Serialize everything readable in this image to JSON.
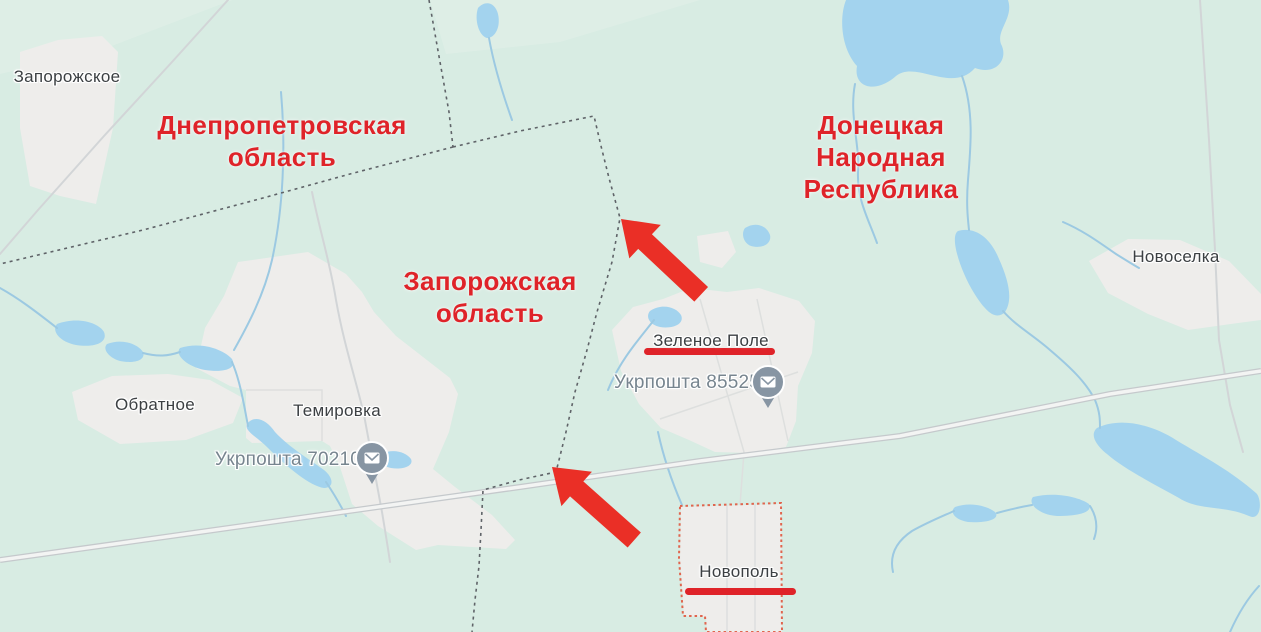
{
  "colors": {
    "land": "#d8ece3",
    "water": "#a3d3ee",
    "water_stroke": "#9cc9e2",
    "settlement": "#eeedeb",
    "road_casing": "#c5c9cc",
    "road_fill": "#f3f4f3",
    "thin_road": "#d2d5d7",
    "boundary": "#5f6368",
    "region_highlight": "#e0654e",
    "annotation_red": "#df2329",
    "arrow_red": "#ea2f26",
    "place_label": "#3c4043",
    "poi_label": "#77858f",
    "pin_fill": "#8795a3"
  },
  "region_labels": [
    {
      "id": "dnipropetrovsk-oblast",
      "text": "Днепропетровская\nобласть"
    },
    {
      "id": "donetsk-peoples-republic",
      "text": "Донецкая\nНародная\nРеспублика"
    },
    {
      "id": "zaporizhzhia-oblast",
      "text": "Запорожская\nобласть"
    }
  ],
  "place_labels": [
    {
      "id": "zaporozhskoe",
      "text": "Запорожское"
    },
    {
      "id": "novoselka",
      "text": "Новоселка"
    },
    {
      "id": "obratnoe",
      "text": "Обратное"
    },
    {
      "id": "temirovka",
      "text": "Темировка"
    },
    {
      "id": "zelenoe-pole",
      "text": "Зеленое Поле",
      "underlined": true
    },
    {
      "id": "novopol",
      "text": "Новополь",
      "underlined": true
    }
  ],
  "poi_labels": [
    {
      "id": "ukrposhta-85525",
      "text": "Укрпошта 85525",
      "icon": "mail-pin-icon"
    },
    {
      "id": "ukrposhta-70210",
      "text": "Укрпошта 70210",
      "icon": "mail-pin-icon"
    }
  ],
  "annotations": {
    "arrows": [
      {
        "id": "arrow-at-oblast-boundary"
      },
      {
        "id": "arrow-at-road-boundary-crossing"
      }
    ]
  }
}
